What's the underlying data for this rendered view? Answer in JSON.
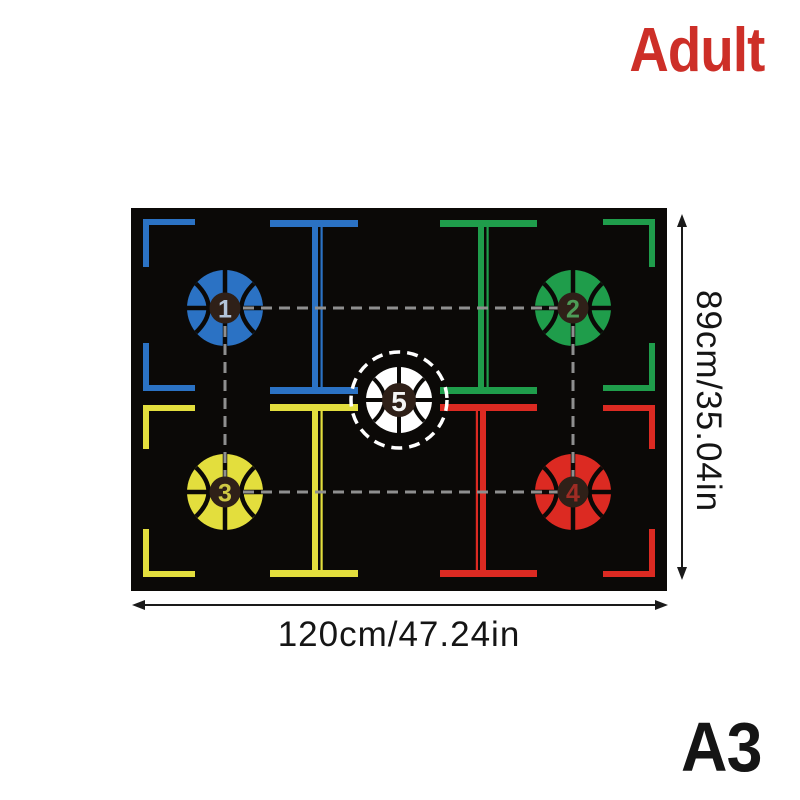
{
  "product": {
    "audience_label": "Adult",
    "size_label": "A3"
  },
  "dimensions": {
    "width_label": "120cm/47.24in",
    "height_label": "89cm/35.04in"
  },
  "mat": {
    "balls": [
      {
        "number": "1",
        "fill": "#2b72c4",
        "number_color": "#b3c4da"
      },
      {
        "number": "2",
        "fill": "#1f9d4b",
        "number_color": "#4d9c57"
      },
      {
        "number": "3",
        "fill": "#e3de3d",
        "number_color": "#cfc843"
      },
      {
        "number": "4",
        "fill": "#dc2a22",
        "number_color": "#a02c24"
      },
      {
        "number": "5",
        "fill": "#ffffff",
        "number_color": "#f5f5f5"
      }
    ],
    "colors": {
      "mat_background": "#0b0907",
      "zone_blue": "#2b72c4",
      "zone_green": "#1f9d4b",
      "zone_yellow": "#e3de3d",
      "zone_red": "#dc2a22",
      "dashed_line": "#8f8f8f",
      "center_ring": "#ffffff",
      "number_circle": "#2f2018"
    }
  },
  "annotations": {
    "adult_color": "#cd2f28",
    "text_color": "#151515"
  }
}
